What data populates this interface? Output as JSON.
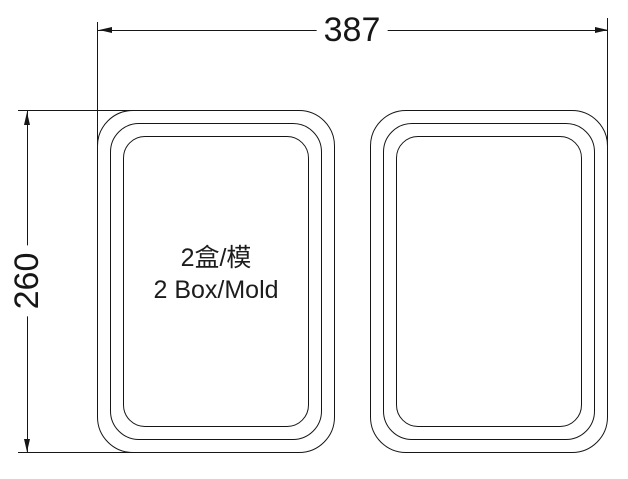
{
  "drawing": {
    "background_color": "#ffffff",
    "line_color": "#161616",
    "width_dimension": "387",
    "height_dimension": "260",
    "cavity_label": {
      "line1": "2盒/模",
      "line2": "2 Box/Mold"
    }
  }
}
